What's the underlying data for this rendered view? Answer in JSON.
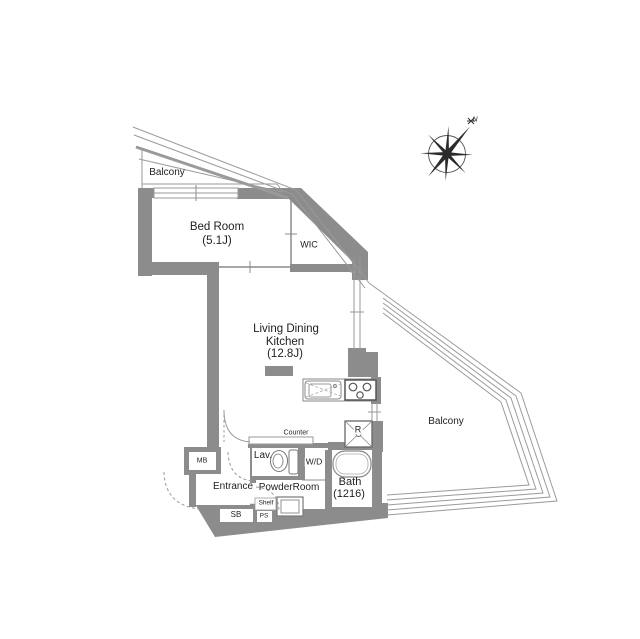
{
  "meta": {
    "type": "apartment-floor-plan"
  },
  "colors": {
    "wall": "#8c8c8c",
    "line": "#9a9a9a",
    "fixture_dark": "#5a5a5a",
    "text": "#1e1e1e"
  },
  "rooms": {
    "balcony_top": {
      "name": "Balcony"
    },
    "bedroom": {
      "name": "Bed Room",
      "size": "(5.1J)"
    },
    "wic": {
      "name": "WIC"
    },
    "ldk": {
      "name_line1": "Living Dining",
      "name_line2": "Kitchen",
      "size": "(12.8J)"
    },
    "balcony_main": {
      "name": "Balcony"
    },
    "lavatory": {
      "name": "Lav."
    },
    "powder_room": {
      "name": "PowderRoom"
    },
    "entrance": {
      "name": "Entrance"
    },
    "bath": {
      "name": "Bath",
      "size": "(1216)"
    }
  },
  "fixtures": {
    "counter": "Counter",
    "washer_dryer": "W/D",
    "meter_box": "MB",
    "shoe_box": "SB",
    "pipe_space": "PS",
    "shelf": "Shelf",
    "refrigerator": "R"
  },
  "compass": {
    "north": "N"
  }
}
